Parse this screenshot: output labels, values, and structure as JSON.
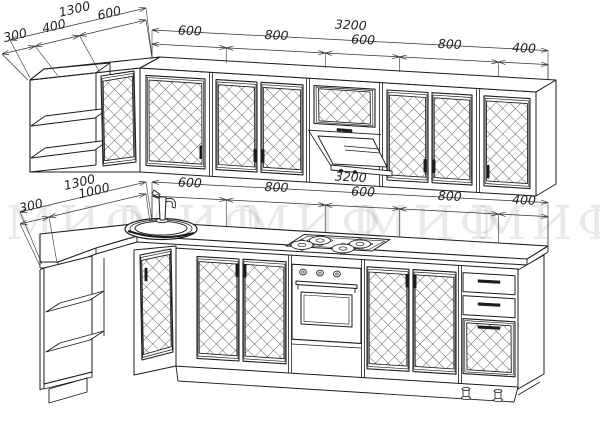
{
  "title": "corner-kitchen-technical-drawing",
  "colors": {
    "background": "#ffffff",
    "line": "#1c1c1c",
    "dimension": "#333333",
    "watermark": "#000000"
  },
  "watermark": {
    "text": "МИФ",
    "repeat": 5,
    "opacity": 0.085
  },
  "dimensions": {
    "upper_left_wall": {
      "total": "1300",
      "segments": [
        "300",
        "400",
        "600"
      ]
    },
    "upper_run": {
      "total": "3200",
      "segments": [
        "600",
        "800",
        "600",
        "800",
        "400"
      ]
    },
    "lower_left_wall": {
      "total": "1300",
      "segments": [
        "300",
        "1000"
      ]
    },
    "lower_run": {
      "total": "3200",
      "segments": [
        "600",
        "800",
        "600",
        "800",
        "400"
      ]
    }
  },
  "fixtures": {
    "upper_corner": "open-corner-shelf",
    "doors": "diamond-lattice-glass-door",
    "hood": "range-hood-cabinet",
    "lower_corner": "open-corner-shelf",
    "sink": "round-sink",
    "faucet": "faucet",
    "cooktop": "gas-cooktop-4-burner",
    "oven": "built-in-oven",
    "drawers": "three-drawer-unit"
  }
}
